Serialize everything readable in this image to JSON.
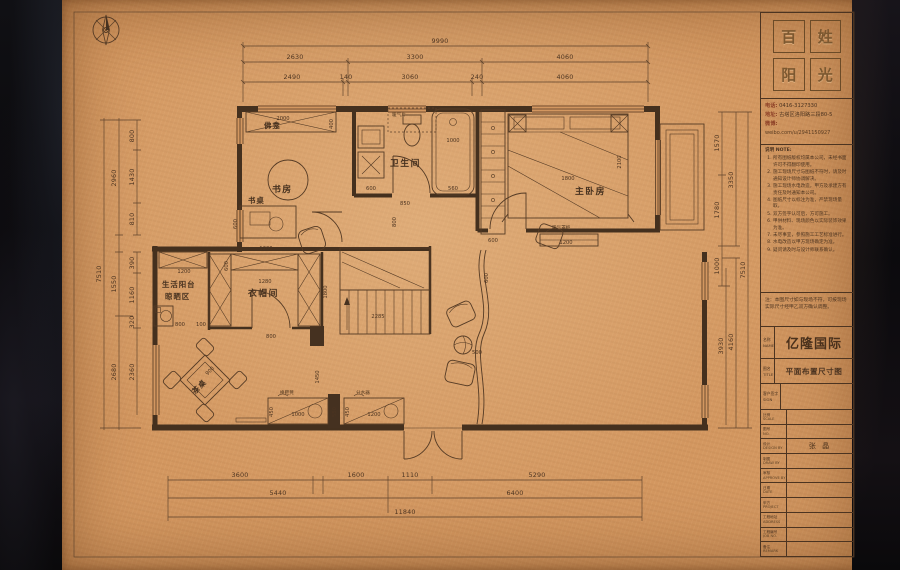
{
  "plan": {
    "rooms": {
      "study": "书房",
      "bath": "卫生间",
      "master": "主卧房",
      "cloak": "衣帽间",
      "life_balcony_1": "生活阳台",
      "life_balcony_2": "晾晒区",
      "tea_table": "茶桌",
      "desk": "书桌",
      "shrine": "佛龛",
      "wardrobe": "衣柜",
      "radiator": "暖气片",
      "radiator_cabinet": "暖气罩柜",
      "shoe_bench": "换鞋凳",
      "manifold": "分水器"
    },
    "dims": {
      "9990": "9990",
      "2630": "2630",
      "3300": "3300",
      "4060": "4060",
      "2490": "2490",
      "140": "140",
      "3060": "3060",
      "240": "240",
      "3600": "3600",
      "1600": "1600",
      "1110": "1110",
      "5290": "5290",
      "5440": "5440",
      "6400": "6400",
      "11840": "11840",
      "800": "800",
      "1430": "1430",
      "810": "810",
      "2960": "2960",
      "390": "390",
      "1160": "1160",
      "320": "320",
      "2360": "2360",
      "1550": "1550",
      "2680": "2680",
      "7510": "7510",
      "1570": "1570",
      "1780": "1780",
      "1000": "1000",
      "3350": "3350",
      "3930": "3930",
      "4160": "4160",
      "2000": "2000",
      "400": "400",
      "600": "600",
      "1200": "1200",
      "850": "850",
      "560": "560",
      "1800": "1800",
      "2100": "2100",
      "1280": "1280",
      "100": "100",
      "2285": "2285",
      "900": "900",
      "450": "450",
      "550": "550",
      "500": "500",
      "1450": "1450"
    }
  },
  "titleblock": {
    "logo_chars": [
      "百",
      "姓",
      "阳",
      "光"
    ],
    "contact": {
      "phone_label": "电话:",
      "phone": "0416-3127330",
      "address_label": "地址:",
      "address": "古塔区洛阳路三段80-5",
      "weibo_label": "微博:",
      "weibo_url": "weibo.com/u/2941150927"
    },
    "notes": {
      "heading": "说明 NOTE:",
      "items": [
        "所有图纸版权均属本公司，未经书面许可不得翻印使用。",
        "施工现场尺寸与图纸不符时，请及时通知设计师协调解决。",
        "施工现场水电改造，甲方及承建方有责任及时通知本公司。",
        "图纸尺寸以标注为准，严禁现场量取。",
        "双方签字认可后，方可施工。",
        "甲供材料、现场颜色以实际装饰效果为准。",
        "未尽事宜，参照施工工艺标准进行。",
        "水电改造以甲方现场确定为准。",
        "疑问请及时与设计师联系确认。"
      ]
    },
    "site_note": "注：本图尺寸如与现场不符，可按现场实际尺寸经甲乙双方确认调整。",
    "project_label": "名称",
    "project_label_en": "NAME",
    "project_name": "亿隆国际",
    "drawing_label": "图名",
    "drawing_label_en": "TITLE",
    "drawing_title": "平面布置尺寸图",
    "signature_label": "客户签字",
    "signature_label_en": "SIGN",
    "designer_name": "张 晶",
    "rows": [
      {
        "label": "比例",
        "en": "SCALE",
        "value": ""
      },
      {
        "label": "图号",
        "en": "NO.",
        "value": ""
      },
      {
        "label": "设计",
        "en": "DESIGN BY",
        "value": "张 晶"
      },
      {
        "label": "制图",
        "en": "DRAW BY",
        "value": ""
      },
      {
        "label": "审核",
        "en": "APPROVE BY",
        "value": ""
      },
      {
        "label": "日期",
        "en": "DATE",
        "value": ""
      }
    ],
    "footer_rows": [
      {
        "label": "甲方",
        "en": "PROJECT"
      },
      {
        "label": "工程地址",
        "en": "ADDRESS"
      },
      {
        "label": "工程编号",
        "en": "JOB NO."
      },
      {
        "label": "备注",
        "en": "REMARK"
      }
    ]
  }
}
